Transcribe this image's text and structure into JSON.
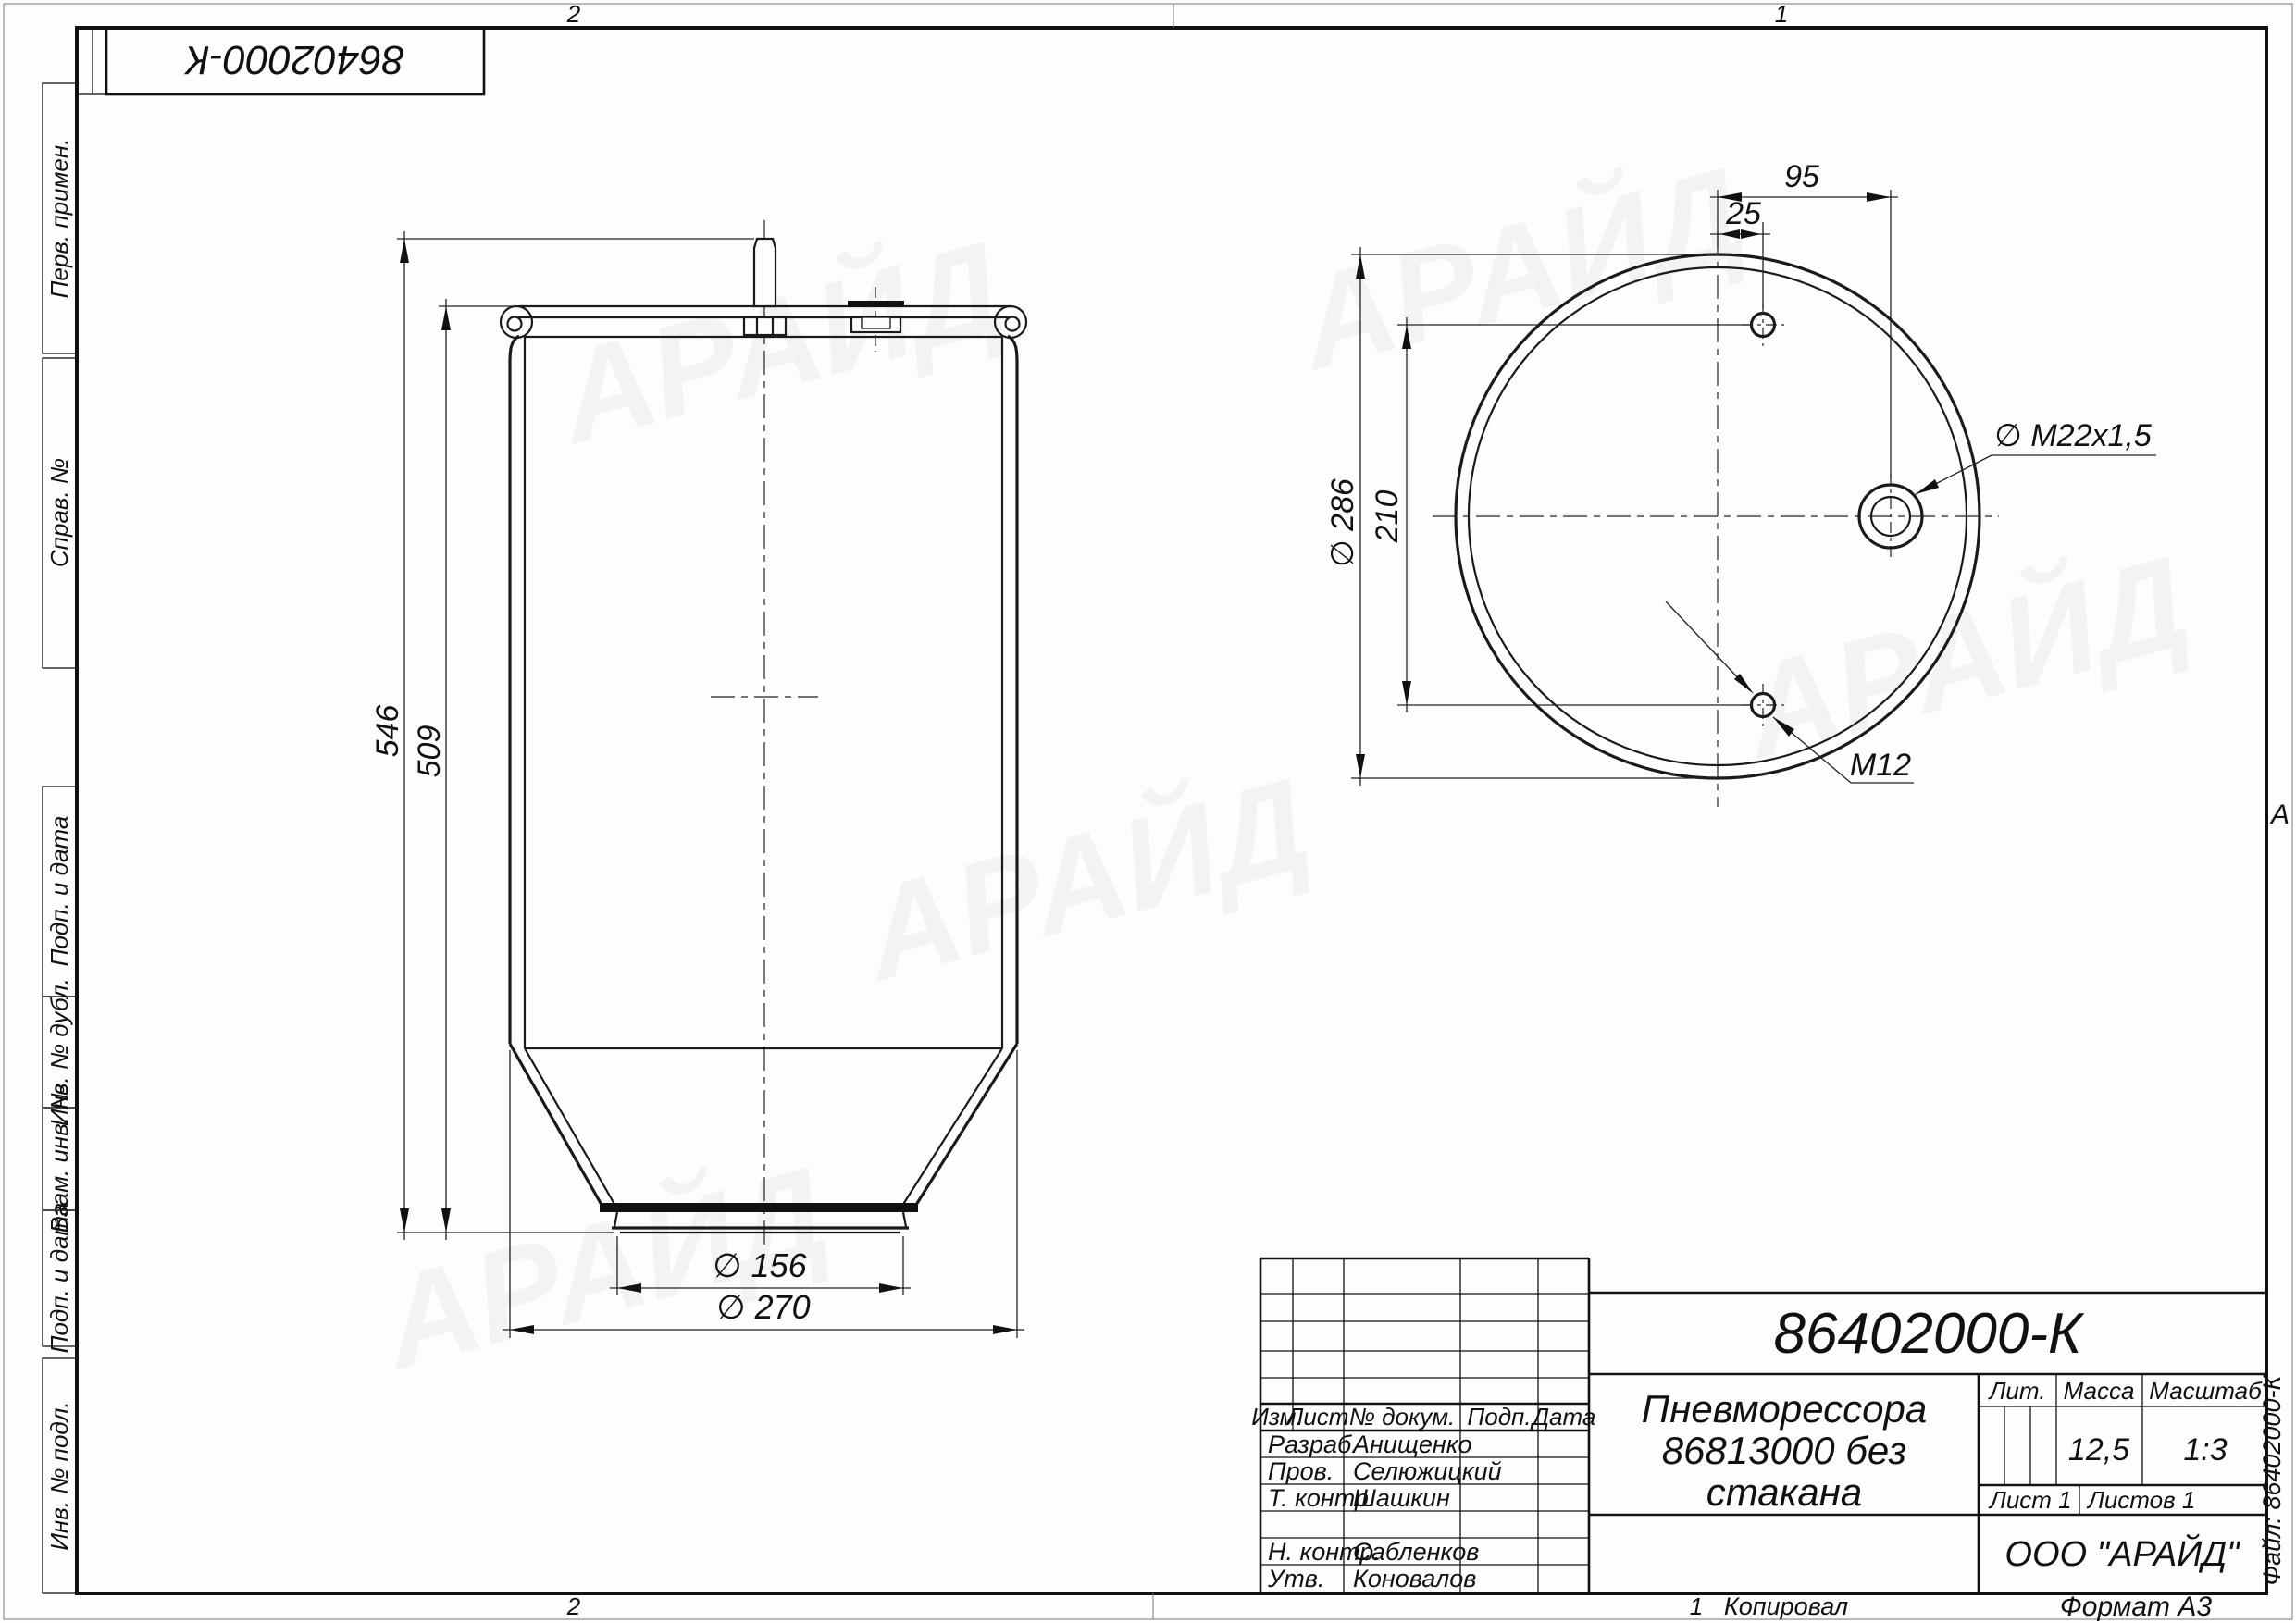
{
  "drawing": {
    "stamp_top_left": "86402000-К",
    "file_label": "Файл: 86402000-К",
    "format_label": "Формат А3",
    "copied_label": "Копировал",
    "zone_letter": "А",
    "zone_top": [
      "2",
      "1"
    ],
    "zone_bottom": [
      "2",
      "1"
    ]
  },
  "sidebar": {
    "labels": [
      "Перв. примен.",
      "Справ. №",
      "Подп. и дата",
      "Инв. № дубл.",
      "Взам. инв. №",
      "Подп. и дата",
      "Инв. № подл."
    ]
  },
  "front_view": {
    "dim_height_total": "546",
    "dim_height_body": "509",
    "dim_dia_bottom": "∅ 156",
    "dim_dia_outer": "∅ 270"
  },
  "top_view": {
    "dim_port_offset": "95",
    "dim_hole_offset": "25",
    "dim_outer_dia": "∅ 286",
    "dim_holes_spacing": "210",
    "label_port_thread": "∅ M22x1,5",
    "label_hole_thread": "M12"
  },
  "title_block": {
    "doc_number": "86402000-К",
    "title_line1": "Пневморессора",
    "title_line2": "86813000 без",
    "title_line3": "стакана",
    "header_cols": [
      "Изм.",
      "Лист",
      "№ докум.",
      "Подп.",
      "Дата"
    ],
    "rows": [
      {
        "role": "Разраб.",
        "name": "Анищенко"
      },
      {
        "role": "Пров.",
        "name": "Селюжицкий"
      },
      {
        "role": "Т. контр.",
        "name": "Шашкин"
      },
      {
        "role": "",
        "name": ""
      },
      {
        "role": "Н. контр.",
        "name": "Сабленков"
      },
      {
        "role": "Утв.",
        "name": "Коновалов"
      }
    ],
    "lit_label": "Лит.",
    "mass_label": "Масса",
    "scale_label": "Масштаб",
    "mass_value": "12,5",
    "scale_value": "1:3",
    "sheet_label": "Лист 1",
    "sheets_label": "Листов 1",
    "company": "ООО \"АРАЙД\""
  },
  "watermark": {
    "text": "АРАЙД"
  }
}
